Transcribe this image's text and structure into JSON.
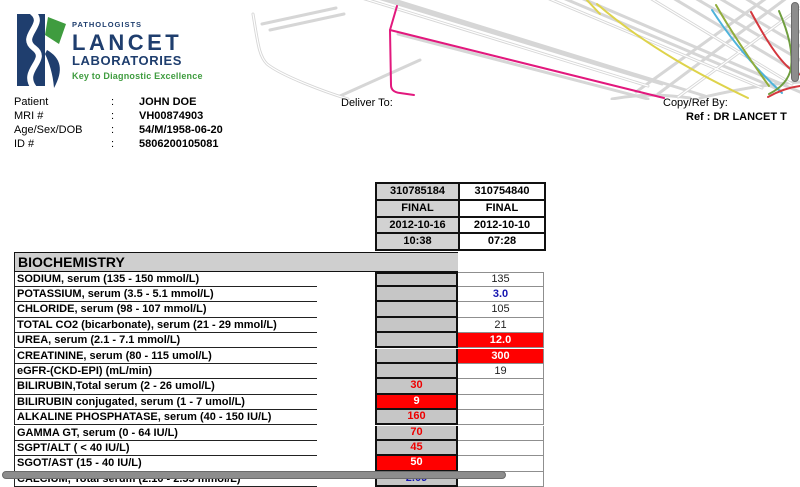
{
  "logo": {
    "pathologists": "PATHOLOGISTS",
    "name": "LANCET",
    "sub": "LABORATORIES",
    "tagline": "Key to Diagnostic Excellence",
    "brand_navy": "#1f3e6e",
    "brand_green": "#3f9c3f"
  },
  "patient": {
    "rows": [
      {
        "label": "Patient",
        "value": "JOHN DOE"
      },
      {
        "label": "MRI #",
        "value": "VH00874903"
      },
      {
        "label": "Age/Sex/DOB",
        "value": "54/M/1958-06-20"
      },
      {
        "label": "ID #",
        "value": "5806200105081"
      }
    ],
    "deliver_to_label": "Deliver To:",
    "copy_ref_label": "Copy/Ref By:",
    "ref_value": "Ref : DR LANCET T"
  },
  "results": {
    "columns": [
      {
        "id": "310785184",
        "status": "FINAL",
        "date": "2012-10-16",
        "time": "10:38"
      },
      {
        "id": "310754840",
        "status": "FINAL",
        "date": "2012-10-10",
        "time": "07:28"
      }
    ],
    "section": "BIOCHEMISTRY",
    "rows": [
      {
        "name": "SODIUM, serum (135 - 150 mmol/L)",
        "v1": "",
        "v1s": "gray",
        "v2": "135",
        "v2s": "normal"
      },
      {
        "name": "POTASSIUM, serum (3.5 - 5.1 mmol/L)",
        "v1": "",
        "v1s": "gray",
        "v2": "3.0",
        "v2s": "low"
      },
      {
        "name": "CHLORIDE, serum (98 - 107 mmol/L)",
        "v1": "",
        "v1s": "gray",
        "v2": "105",
        "v2s": "normal"
      },
      {
        "name": "TOTAL CO2 (bicarbonate), serum (21 - 29 mmol/L)",
        "v1": "",
        "v1s": "gray",
        "v2": "21",
        "v2s": "normal"
      },
      {
        "name": "UREA, serum (2.1 - 7.1 mmol/L)",
        "v1": "",
        "v1s": "gray",
        "v2": "12.0",
        "v2s": "critical"
      },
      {
        "name": "CREATININE, serum (80 - 115 umol/L)",
        "v1": "",
        "v1s": "gray",
        "v2": "300",
        "v2s": "critical"
      },
      {
        "name": "eGFR-(CKD-EPI) (mL/min)",
        "v1": "",
        "v1s": "gray",
        "v2": "19",
        "v2s": "normal"
      },
      {
        "name": "BILIRUBIN,Total serum (2 - 26 umol/L)",
        "v1": "30",
        "v1s": "high",
        "v2": "",
        "v2s": "empty"
      },
      {
        "name": "BILIRUBIN conjugated, serum (1 - 7 umol/L)",
        "v1": "9",
        "v1s": "critical",
        "v2": "",
        "v2s": "empty"
      },
      {
        "name": "ALKALINE PHOSPHATASE, serum (40 - 150 IU/L)",
        "v1": "160",
        "v1s": "high",
        "v2": "",
        "v2s": "empty"
      },
      {
        "name": "GAMMA GT, serum (0 - 64 IU/L)",
        "v1": "70",
        "v1s": "high",
        "v2": "",
        "v2s": "empty"
      },
      {
        "name": "SGPT/ALT ( < 40 IU/L)",
        "v1": "45",
        "v1s": "high",
        "v2": "",
        "v2s": "empty"
      },
      {
        "name": "SGOT/AST (15 - 40 IU/L)",
        "v1": "50",
        "v1s": "critical",
        "v2": "",
        "v2s": "empty"
      },
      {
        "name": "CALCIUM, Total serum (2.10 - 2.55 mmol/L)",
        "v1": "2.09",
        "v1s": "low",
        "v2": "",
        "v2s": "empty"
      }
    ]
  },
  "status_colors": {
    "abnormal_red": "#ff0000",
    "low_blue": "#1515b0",
    "value_cell_gray": "#c6c6c6",
    "header_cell_gray": "#d2d2d2"
  }
}
